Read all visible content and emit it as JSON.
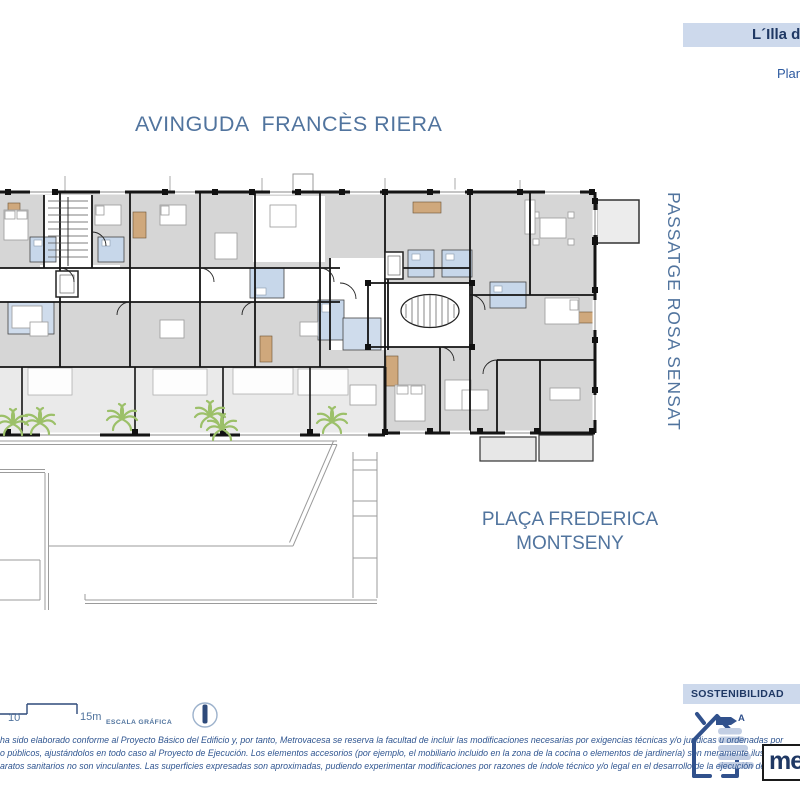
{
  "header": {
    "project_banner": "L´Illa de",
    "plan_label": "Plan"
  },
  "streets": {
    "avinguda": "AVINGUDA  FRANCÈS RIERA",
    "passatge": "PASSATGE ROSA SENSAT",
    "placa_line1": "PLAÇA FREDERICA",
    "placa_line2": "MONTSENY"
  },
  "scale": {
    "mid": "10",
    "end": "15m",
    "caption": "ESCALA GRÁFICA"
  },
  "disclaimer": {
    "line1": "ha sido elaborado conforme al Proyecto Básico del Edificio y, por tanto, Metrovacesa se reserva la facultad de incluir las modificaciones necesarias por exigencias técnicas y/o jurídicas u ordenadas por",
    "line2": "o públicos, ajustándolos en todo caso al Proyecto de Ejecución. Los elementos accesorios (por ejemplo, el mobiliario incluido en la zona de la cocina o elementos de jardinería) son meramente ilustrativos.",
    "line3": "aratos sanitarios no son vinculantes. Las superficies expresadas son aproximadas, pudiendo experimentar modificaciones por razones de índole técnico y/o legal en el desarrollo de la ejecución de las"
  },
  "sustainability": {
    "title": "SOSTENIBILIDAD",
    "energy_rating": "A",
    "brand_fragment": "me"
  },
  "colors": {
    "accent_blue": "#51749e",
    "banner_bg": "#cdd9ec",
    "banner_text": "#1f3864",
    "disclaimer_text": "#2f5590",
    "wall": "#141414",
    "room_gray": "#d6d6d6",
    "terrace_gray": "#eaeaea",
    "bath_blue": "#c7d7ea",
    "wood_tan": "#cfa87c",
    "palm_green": "#9cc069",
    "site_line": "#9b9b9b"
  }
}
